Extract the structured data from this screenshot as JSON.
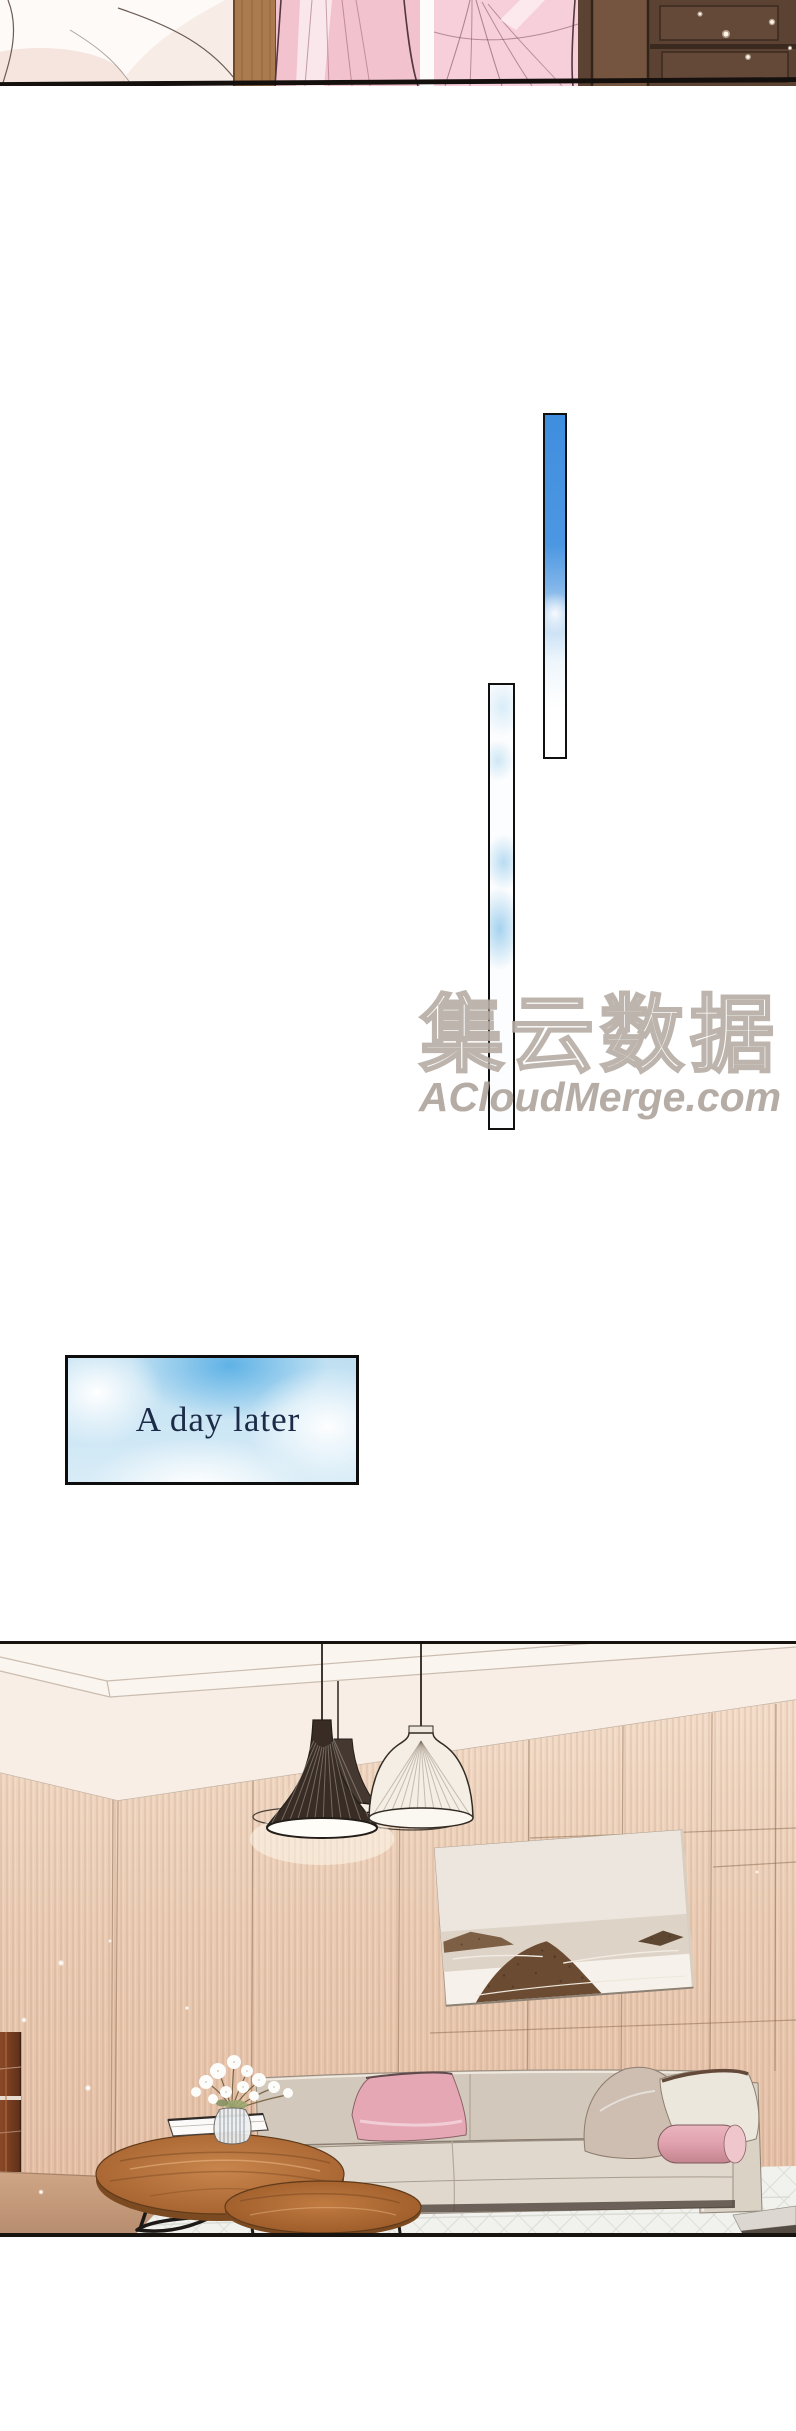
{
  "page": {
    "width_px": 796,
    "height_px": 2431,
    "background": "#ffffff"
  },
  "watermark": {
    "logo_text": "集云数据",
    "site_text": "ACloudMerge.com",
    "text_color": "#a89e95",
    "outline_color": "#b2a89f"
  },
  "caption": {
    "text": "A day later",
    "text_color": "#1c2b47",
    "border_color": "#0d0d0d",
    "sky_color": "#5fb2e6",
    "cloud_color": "#ffffff"
  },
  "panels": {
    "top_sliver": {
      "wall_dark": "#5c4233",
      "dress_pink": "#f3c2cf",
      "wood_pillar": "#aa7b4f",
      "fabric_pale": "#f8ece7"
    },
    "sky_strip_tall": {
      "top_color": "#4190e0",
      "fade_color": "#ffffff",
      "border_color": "#101010"
    },
    "sky_strip_long": {
      "cloud_color": "#a9d3ee",
      "border_color": "#101010"
    },
    "living_room": {
      "border_color": "#17130f",
      "ceiling_color": "#fbf5ef",
      "wall_wood_color": "#e9cbb3",
      "sofa_color": "#d7cec2",
      "pillow_pink": "#e6a7b4",
      "pillow_taupe": "#cdbeb1",
      "pillow_white": "#ebe7dc",
      "bolster_pink": "#dfa0ad",
      "table_wood_color": "#b5713f",
      "rug_color": "#f1f1ed",
      "floor_wood_color": "#c49c7e",
      "cabinet_color": "#7a3c22",
      "lamp_dark": "#382c24",
      "lamp_light": "#f4eee5",
      "painting_rock": "#6b4c33"
    }
  }
}
